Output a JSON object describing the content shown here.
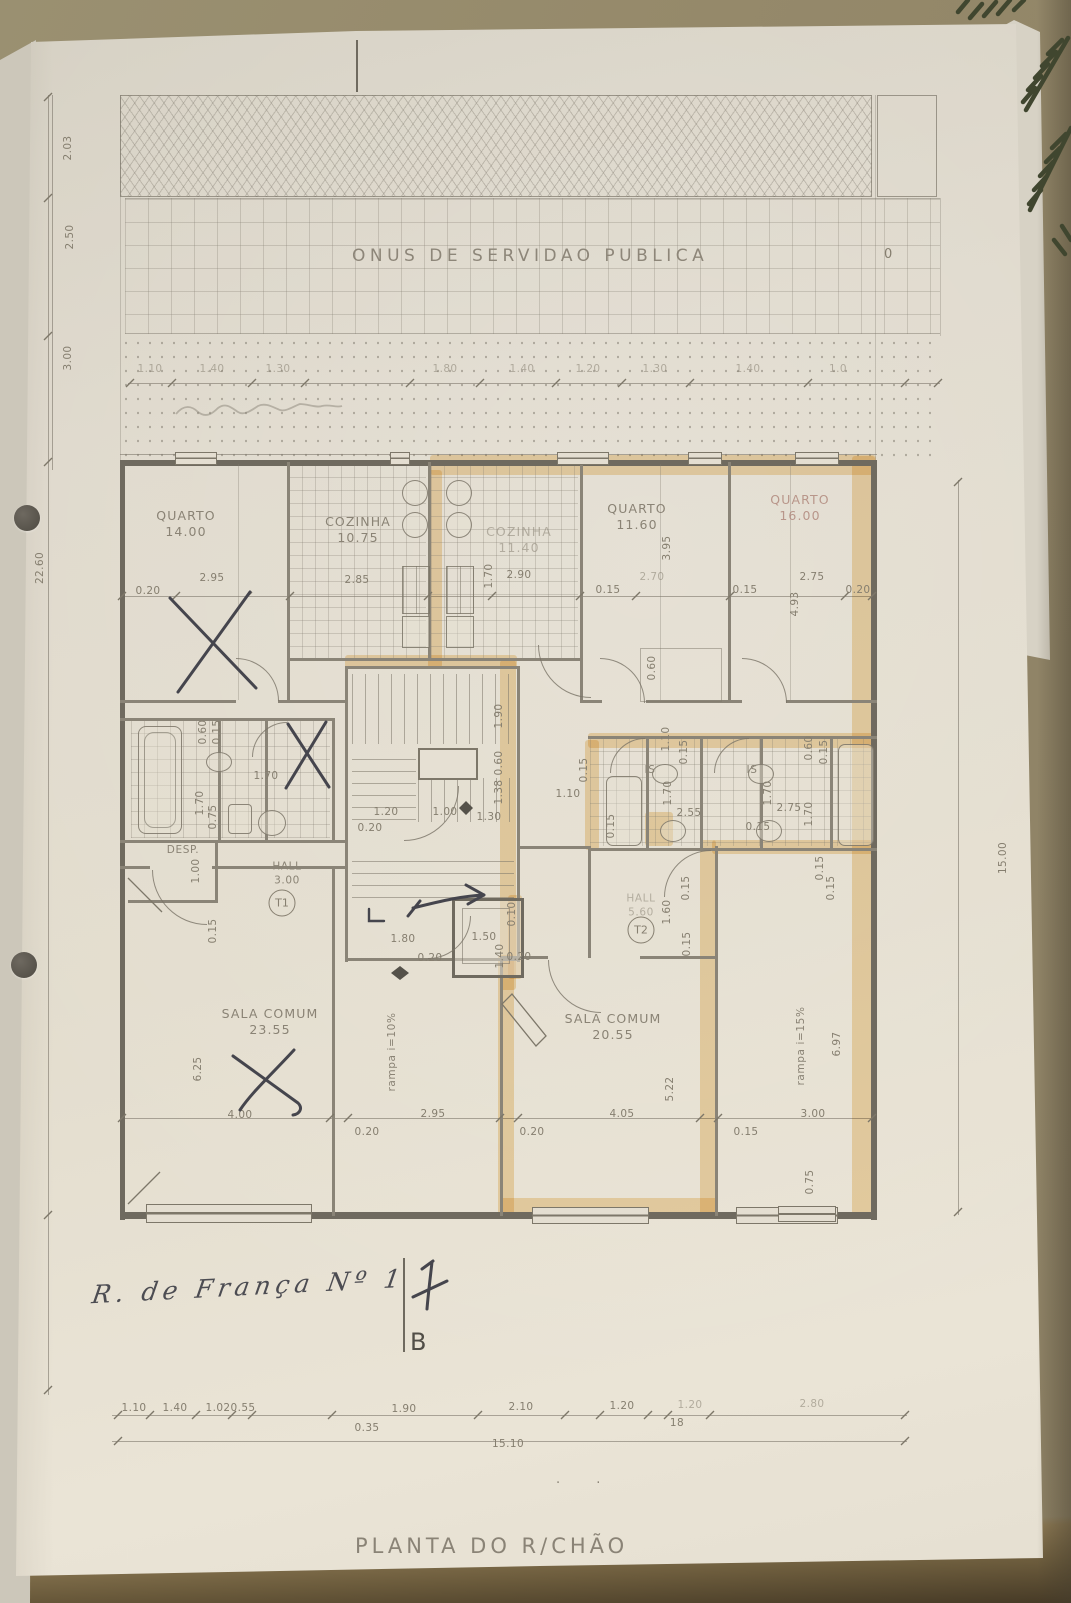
{
  "easement_band": {
    "label": "ONUS DE SERVIDAO PUBLICA"
  },
  "datum_marker": "0",
  "plan_title": "PLANTA DO R/CHÃO",
  "handwriting": {
    "street": "R. de França Nº 1",
    "section": "B"
  },
  "apartment_tags": {
    "t1": "T1",
    "t2": "T2"
  },
  "colors": {
    "highlighter": "#ecb95e",
    "pen": "#45454d",
    "pencil": "#857e6f",
    "paper": "#e3ddce"
  },
  "rooms": [
    {
      "name": "QUARTO",
      "area": "14.00",
      "x": 186,
      "y": 524
    },
    {
      "name": "COZINHA",
      "area": "10.75",
      "x": 358,
      "y": 530
    },
    {
      "name": "COZINHA",
      "area": "11.40",
      "x": 519,
      "y": 540,
      "cls": "f"
    },
    {
      "name": "QUARTO",
      "area": "11.60",
      "x": 637,
      "y": 517
    },
    {
      "name": "QUARTO",
      "area": "16.00",
      "x": 800,
      "y": 508,
      "cls": "pink"
    },
    {
      "name": "DESP.",
      "x": 183,
      "y": 851,
      "small": 1
    },
    {
      "name": "HALL",
      "area": "3.00",
      "x": 287,
      "y": 874,
      "small": 1
    },
    {
      "name": "HALL",
      "area": "5.60",
      "x": 641,
      "y": 906,
      "small": 1,
      "cls": "f"
    },
    {
      "name": "IS",
      "x": 650,
      "y": 771,
      "small": 1
    },
    {
      "name": "IS",
      "x": 752,
      "y": 771,
      "small": 1
    },
    {
      "name": "SALA COMUM",
      "area": "23.55",
      "x": 270,
      "y": 1022
    },
    {
      "name": "SALA COMUM",
      "area": "20.55",
      "x": 613,
      "y": 1027
    },
    {
      "name": "rampa i=10%",
      "x": 393,
      "y": 1052,
      "rot": -90,
      "small": 1
    },
    {
      "name": "rampa i=15%",
      "x": 802,
      "y": 1046,
      "rot": -90,
      "small": 1
    }
  ],
  "dims": [
    {
      "t": "1.10",
      "x": 150,
      "y": 369,
      "f": 1
    },
    {
      "t": "1.40",
      "x": 212,
      "y": 369,
      "f": 1
    },
    {
      "t": "1.30",
      "x": 278,
      "y": 369,
      "f": 1
    },
    {
      "t": "1.80",
      "x": 445,
      "y": 369,
      "f": 1
    },
    {
      "t": "1.40",
      "x": 522,
      "y": 369,
      "f": 1
    },
    {
      "t": "1.20",
      "x": 588,
      "y": 369,
      "f": 1
    },
    {
      "t": "1.30",
      "x": 655,
      "y": 369,
      "f": 1
    },
    {
      "t": "1.40",
      "x": 748,
      "y": 369,
      "f": 1
    },
    {
      "t": "1.0",
      "x": 838,
      "y": 369,
      "f": 1
    },
    {
      "t": "2.03",
      "x": 68,
      "y": 148,
      "r": 1
    },
    {
      "t": "2.50",
      "x": 70,
      "y": 237,
      "r": 1
    },
    {
      "t": "3.00",
      "x": 68,
      "y": 358,
      "r": 1
    },
    {
      "t": "22.60",
      "x": 40,
      "y": 568,
      "r": 1
    },
    {
      "t": "15.00",
      "x": 1003,
      "y": 858,
      "r": 1
    },
    {
      "t": "0.20",
      "x": 148,
      "y": 591
    },
    {
      "t": "2.95",
      "x": 212,
      "y": 578
    },
    {
      "t": "2.85",
      "x": 357,
      "y": 580
    },
    {
      "t": "1.70",
      "x": 489,
      "y": 576,
      "r": 1
    },
    {
      "t": "2.90",
      "x": 519,
      "y": 575
    },
    {
      "t": "0.15",
      "x": 608,
      "y": 590
    },
    {
      "t": "2.70",
      "x": 652,
      "y": 577,
      "f": 1
    },
    {
      "t": "3.95",
      "x": 667,
      "y": 548,
      "r": 1
    },
    {
      "t": "0.15",
      "x": 745,
      "y": 590
    },
    {
      "t": "2.75",
      "x": 812,
      "y": 577
    },
    {
      "t": "0.20",
      "x": 858,
      "y": 590
    },
    {
      "t": "4.93",
      "x": 795,
      "y": 604,
      "r": 1
    },
    {
      "t": "0.60",
      "x": 652,
      "y": 668,
      "r": 1
    },
    {
      "t": "0.60",
      "x": 203,
      "y": 732,
      "r": 1
    },
    {
      "t": "0.15",
      "x": 217,
      "y": 732,
      "r": 1
    },
    {
      "t": "1.70",
      "x": 266,
      "y": 776
    },
    {
      "t": "1.70",
      "x": 200,
      "y": 803,
      "r": 1
    },
    {
      "t": "0.75",
      "x": 213,
      "y": 817,
      "r": 1
    },
    {
      "t": "1.90",
      "x": 499,
      "y": 716,
      "r": 1
    },
    {
      "t": "0.60",
      "x": 499,
      "y": 763,
      "r": 1
    },
    {
      "t": "1.38",
      "x": 499,
      "y": 792,
      "r": 1
    },
    {
      "t": "1.20",
      "x": 386,
      "y": 812
    },
    {
      "t": "1.00",
      "x": 445,
      "y": 812
    },
    {
      "t": "1.30",
      "x": 489,
      "y": 817
    },
    {
      "t": "0.20",
      "x": 370,
      "y": 828
    },
    {
      "t": "1.10",
      "x": 568,
      "y": 794
    },
    {
      "t": "0.15",
      "x": 584,
      "y": 770,
      "r": 1
    },
    {
      "t": "1.00",
      "x": 196,
      "y": 871,
      "r": 1
    },
    {
      "t": "0.15",
      "x": 213,
      "y": 931,
      "r": 1
    },
    {
      "t": "1.80",
      "x": 403,
      "y": 939
    },
    {
      "t": "0.20",
      "x": 430,
      "y": 958
    },
    {
      "t": "1.50",
      "x": 484,
      "y": 937
    },
    {
      "t": "1.40",
      "x": 500,
      "y": 956,
      "r": 1
    },
    {
      "t": "0.20",
      "x": 519,
      "y": 957
    },
    {
      "t": "0.10",
      "x": 512,
      "y": 914,
      "r": 1
    },
    {
      "t": "1.60",
      "x": 667,
      "y": 912,
      "r": 1
    },
    {
      "t": "0.15",
      "x": 686,
      "y": 888,
      "r": 1
    },
    {
      "t": "0.15",
      "x": 687,
      "y": 944,
      "r": 1
    },
    {
      "t": "0.15",
      "x": 831,
      "y": 888,
      "r": 1
    },
    {
      "t": "1.10",
      "x": 666,
      "y": 739,
      "r": 1
    },
    {
      "t": "0.15",
      "x": 684,
      "y": 752,
      "r": 1
    },
    {
      "t": "0.60",
      "x": 809,
      "y": 748,
      "r": 1
    },
    {
      "t": "0.15",
      "x": 824,
      "y": 752,
      "r": 1
    },
    {
      "t": "1.70",
      "x": 668,
      "y": 793,
      "r": 1
    },
    {
      "t": "1.70",
      "x": 768,
      "y": 793,
      "r": 1
    },
    {
      "t": "2.55",
      "x": 689,
      "y": 813
    },
    {
      "t": "2.75",
      "x": 789,
      "y": 808
    },
    {
      "t": "1.70",
      "x": 809,
      "y": 814,
      "r": 1
    },
    {
      "t": "0.15",
      "x": 611,
      "y": 826,
      "r": 1
    },
    {
      "t": "0.15",
      "x": 758,
      "y": 827
    },
    {
      "t": "6.25",
      "x": 198,
      "y": 1069,
      "r": 1
    },
    {
      "t": "4.00",
      "x": 240,
      "y": 1115
    },
    {
      "t": "0.20",
      "x": 367,
      "y": 1132
    },
    {
      "t": "2.95",
      "x": 433,
      "y": 1114
    },
    {
      "t": "5.22",
      "x": 670,
      "y": 1089,
      "r": 1
    },
    {
      "t": "4.05",
      "x": 622,
      "y": 1114
    },
    {
      "t": "0.20",
      "x": 532,
      "y": 1132
    },
    {
      "t": "0.15",
      "x": 746,
      "y": 1132
    },
    {
      "t": "6.97",
      "x": 837,
      "y": 1044,
      "r": 1
    },
    {
      "t": "3.00",
      "x": 813,
      "y": 1114
    },
    {
      "t": "0.75",
      "x": 810,
      "y": 1182,
      "r": 1
    },
    {
      "t": "0.15",
      "x": 820,
      "y": 868,
      "r": 1
    },
    {
      "t": "1.10",
      "x": 134,
      "y": 1408
    },
    {
      "t": "1.40",
      "x": 175,
      "y": 1408
    },
    {
      "t": "1.02",
      "x": 218,
      "y": 1408
    },
    {
      "t": "0.55",
      "x": 243,
      "y": 1408
    },
    {
      "t": "1.90",
      "x": 404,
      "y": 1409
    },
    {
      "t": "2.10",
      "x": 521,
      "y": 1407
    },
    {
      "t": "1.20",
      "x": 622,
      "y": 1406
    },
    {
      "t": "1.20",
      "x": 690,
      "y": 1405,
      "f": 1
    },
    {
      "t": "0.35",
      "x": 367,
      "y": 1428
    },
    {
      "t": "18",
      "x": 677,
      "y": 1423
    },
    {
      "t": "2.80",
      "x": 812,
      "y": 1404,
      "f": 1
    },
    {
      "t": "15.10",
      "x": 508,
      "y": 1444
    }
  ]
}
